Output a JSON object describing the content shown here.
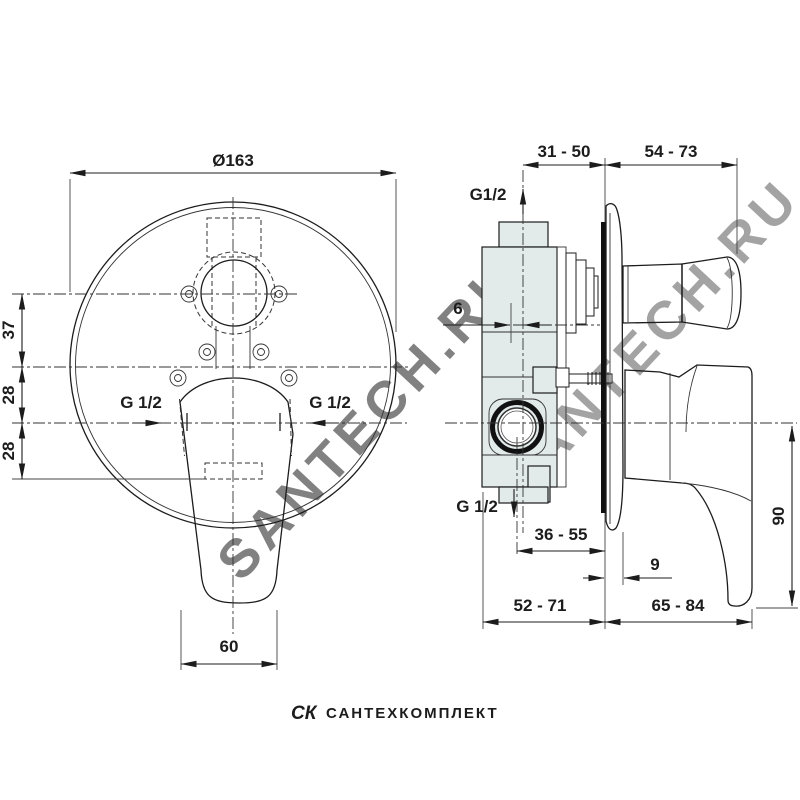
{
  "front": {
    "diameter": "Ø163",
    "dim_top": "37",
    "dim_mid": "28",
    "dim_bottom": "28",
    "port_left": "G 1/2",
    "port_right": "G 1/2",
    "lever_width": "60"
  },
  "side": {
    "span_wall_min_max": "31 - 50",
    "span_front_min_max": "54 - 73",
    "port_top": "G1/2",
    "offset": "6",
    "port_bottom": "G 1/2",
    "span_outlet": "36 - 55",
    "plate_depth": "9",
    "span_body": "52 - 71",
    "span_handle": "65 - 84",
    "handle_height": "90"
  },
  "watermark": {
    "diagonal": "SANTECH.RU",
    "footer_logo": "СК",
    "footer_text": "САНТЕХКОМПЛЕКТ"
  },
  "colors": {
    "line": "#1c1c1c",
    "body_fill": "#e2eaea",
    "wall": "#111111",
    "watermark": "#d4d4d4",
    "footer_watermark": "#e9e9e9",
    "background": "#ffffff"
  }
}
